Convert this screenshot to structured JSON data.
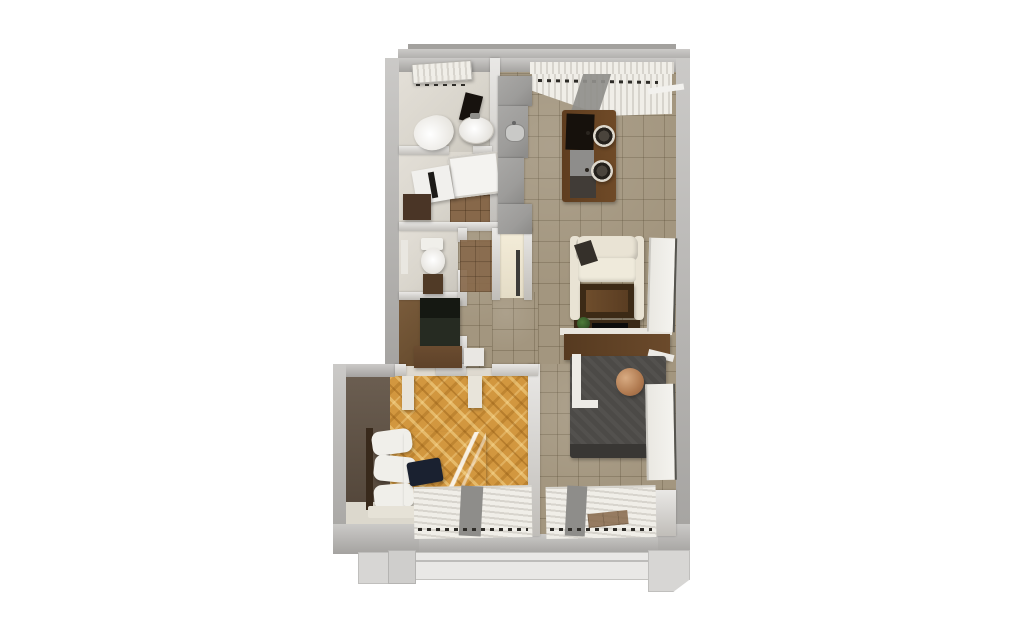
{
  "meta": {
    "scene": "3D rendered top-down floor plan of a one-bedroom apartment",
    "view": "bird's-eye axonometric",
    "visible_text": "none"
  },
  "colors": {
    "bg": "#ffffff",
    "outer_wall": "#b7b5b2",
    "outer_wall_dark": "#a3a19e",
    "inner_wall": "#cfccc7",
    "wall_face": "#ded9cf",
    "tile_floor": "#a3967f",
    "bath_floor": "#d9d5cc",
    "parquet": "#d2973f",
    "counter": "#9d9c9a",
    "wood_dark": "#563a20",
    "wood_mid": "#6b4a2b",
    "sofa": "#e9e3d4",
    "bed_gray": "#4c4a47",
    "bed_gray_dark": "#393734",
    "copper": "#b07a50",
    "duvet_brown": "#5d4434",
    "pillow": "#f0efea",
    "navy_cushion": "#1a2130",
    "wardrobe_dark": "#262b22",
    "dresser_brown": "#5e4229",
    "blind": "#f0eee8",
    "blind_shadow": "#d7d4cd",
    "blind_band": "#8e8d8a",
    "balcony": "#e9e8e6",
    "balcony_edge": "#c4c3c0",
    "bedroom_wall": "#6b5e51",
    "plant_green": "#4e7c3a",
    "device_black": "#0c0c0c"
  },
  "rooms": [
    {
      "name": "bathroom",
      "position": "top-left",
      "furniture": [
        "window-blinds",
        "mirror",
        "round-sink",
        "toilet"
      ]
    },
    {
      "name": "shower-laundry-room",
      "position": "mid-left",
      "furniture": [
        "shower-tray",
        "washing-machine",
        "dark-cabinet",
        "brown-tile-patch"
      ]
    },
    {
      "name": "wc",
      "position": "mid-left",
      "furniture": [
        "toilet",
        "vanity-cabinet",
        "wall-niche"
      ]
    },
    {
      "name": "closet",
      "position": "mid-left",
      "furniture": [
        "dark-wardrobe",
        "wood-dresser",
        "storage-box"
      ]
    },
    {
      "name": "kitchen-nook",
      "position": "top-center",
      "furniture": [
        "counter-run",
        "kitchen-sink",
        "upper-cabinet"
      ]
    },
    {
      "name": "living-dining-room",
      "position": "right",
      "furniture": [
        "window-blinds-top",
        "gray-curtain",
        "dining-table",
        "laptop",
        "two-round-chairs",
        "gray-stool",
        "cream-sofa",
        "dark-throw",
        "coffee-table",
        "media-console",
        "plant",
        "soundbar",
        "headboard-shelf",
        "gray-double-bed",
        "copper-round-pillow",
        "radiator-panel-upper",
        "radiator-panel-lower",
        "window-blinds-bottom"
      ]
    },
    {
      "name": "bedroom",
      "position": "bottom-left",
      "furniture": [
        "herringbone-parquet",
        "dark-accent-wall",
        "double-bed-brown-duvet",
        "white-pillows",
        "navy-cushion",
        "bed-skirt",
        "door-jambs",
        "window-blinds-bottom"
      ]
    },
    {
      "name": "hallway",
      "position": "center",
      "furniture": [
        "entry-alcove",
        "entry-door",
        "door-mat"
      ]
    },
    {
      "name": "balcony-top",
      "position": "top",
      "furniture": [
        "ledge"
      ]
    },
    {
      "name": "balcony-bottom",
      "position": "bottom",
      "furniture": [
        "railing",
        "posts"
      ]
    }
  ]
}
